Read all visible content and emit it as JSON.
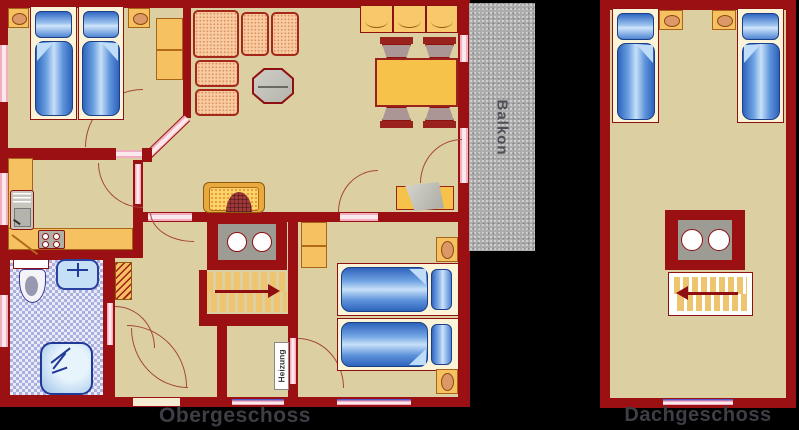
{
  "image_type": "apartment floor plan",
  "floor_plans": [
    {
      "name": "Obergeschoss",
      "label": "Obergeschoss",
      "rooms": [
        {
          "name": "bedroom-1",
          "furniture": [
            "single-bed",
            "single-bed",
            "nightstand-lamp",
            "nightstand-lamp",
            "wardrobe"
          ]
        },
        {
          "name": "living-room",
          "furniture": [
            "corner-sofa",
            "coffee-table",
            "sideboard",
            "dining-table",
            "chair",
            "chair",
            "chair",
            "chair",
            "tv",
            "tiled-stove"
          ]
        },
        {
          "name": "kitchen",
          "furniture": [
            "sink-unit",
            "stove-4-burner",
            "counter"
          ]
        },
        {
          "name": "bathroom",
          "furniture": [
            "toilet",
            "washbasin",
            "shower"
          ]
        },
        {
          "name": "hallway",
          "furniture": [
            "radiator"
          ]
        },
        {
          "name": "staircase",
          "furniture": [
            "stairs-up-arrow",
            "chimney-two-flues"
          ]
        },
        {
          "name": "heating-room",
          "label": "Heizung"
        },
        {
          "name": "bedroom-2",
          "furniture": [
            "single-bed",
            "single-bed",
            "nightstand-lamp",
            "nightstand-lamp",
            "wardrobe"
          ]
        },
        {
          "name": "balcony",
          "label": "Balkon"
        }
      ]
    },
    {
      "name": "Dachgeschoss",
      "label": "Dachgeschoss",
      "rooms": [
        {
          "name": "attic-room",
          "furniture": [
            "single-bed",
            "single-bed",
            "nightstand-lamp",
            "nightstand-lamp",
            "chimney-two-flues",
            "stairs-down-arrow"
          ]
        }
      ]
    }
  ],
  "annotations": {
    "balcony": "Balkon",
    "heating": "Heizung"
  },
  "colors": {
    "background": "#000000",
    "wall_red": "#9B1013",
    "floor_beige": "#DCD0A2",
    "bed_blue": "#4D87D9",
    "furniture_orange": "#F6C261",
    "balcony_gray": "#ACACAC",
    "bathroom_tile_blue": "#A9B0DF",
    "label_gray": "#3E3E46",
    "window_pink": "#F0AEBE"
  }
}
